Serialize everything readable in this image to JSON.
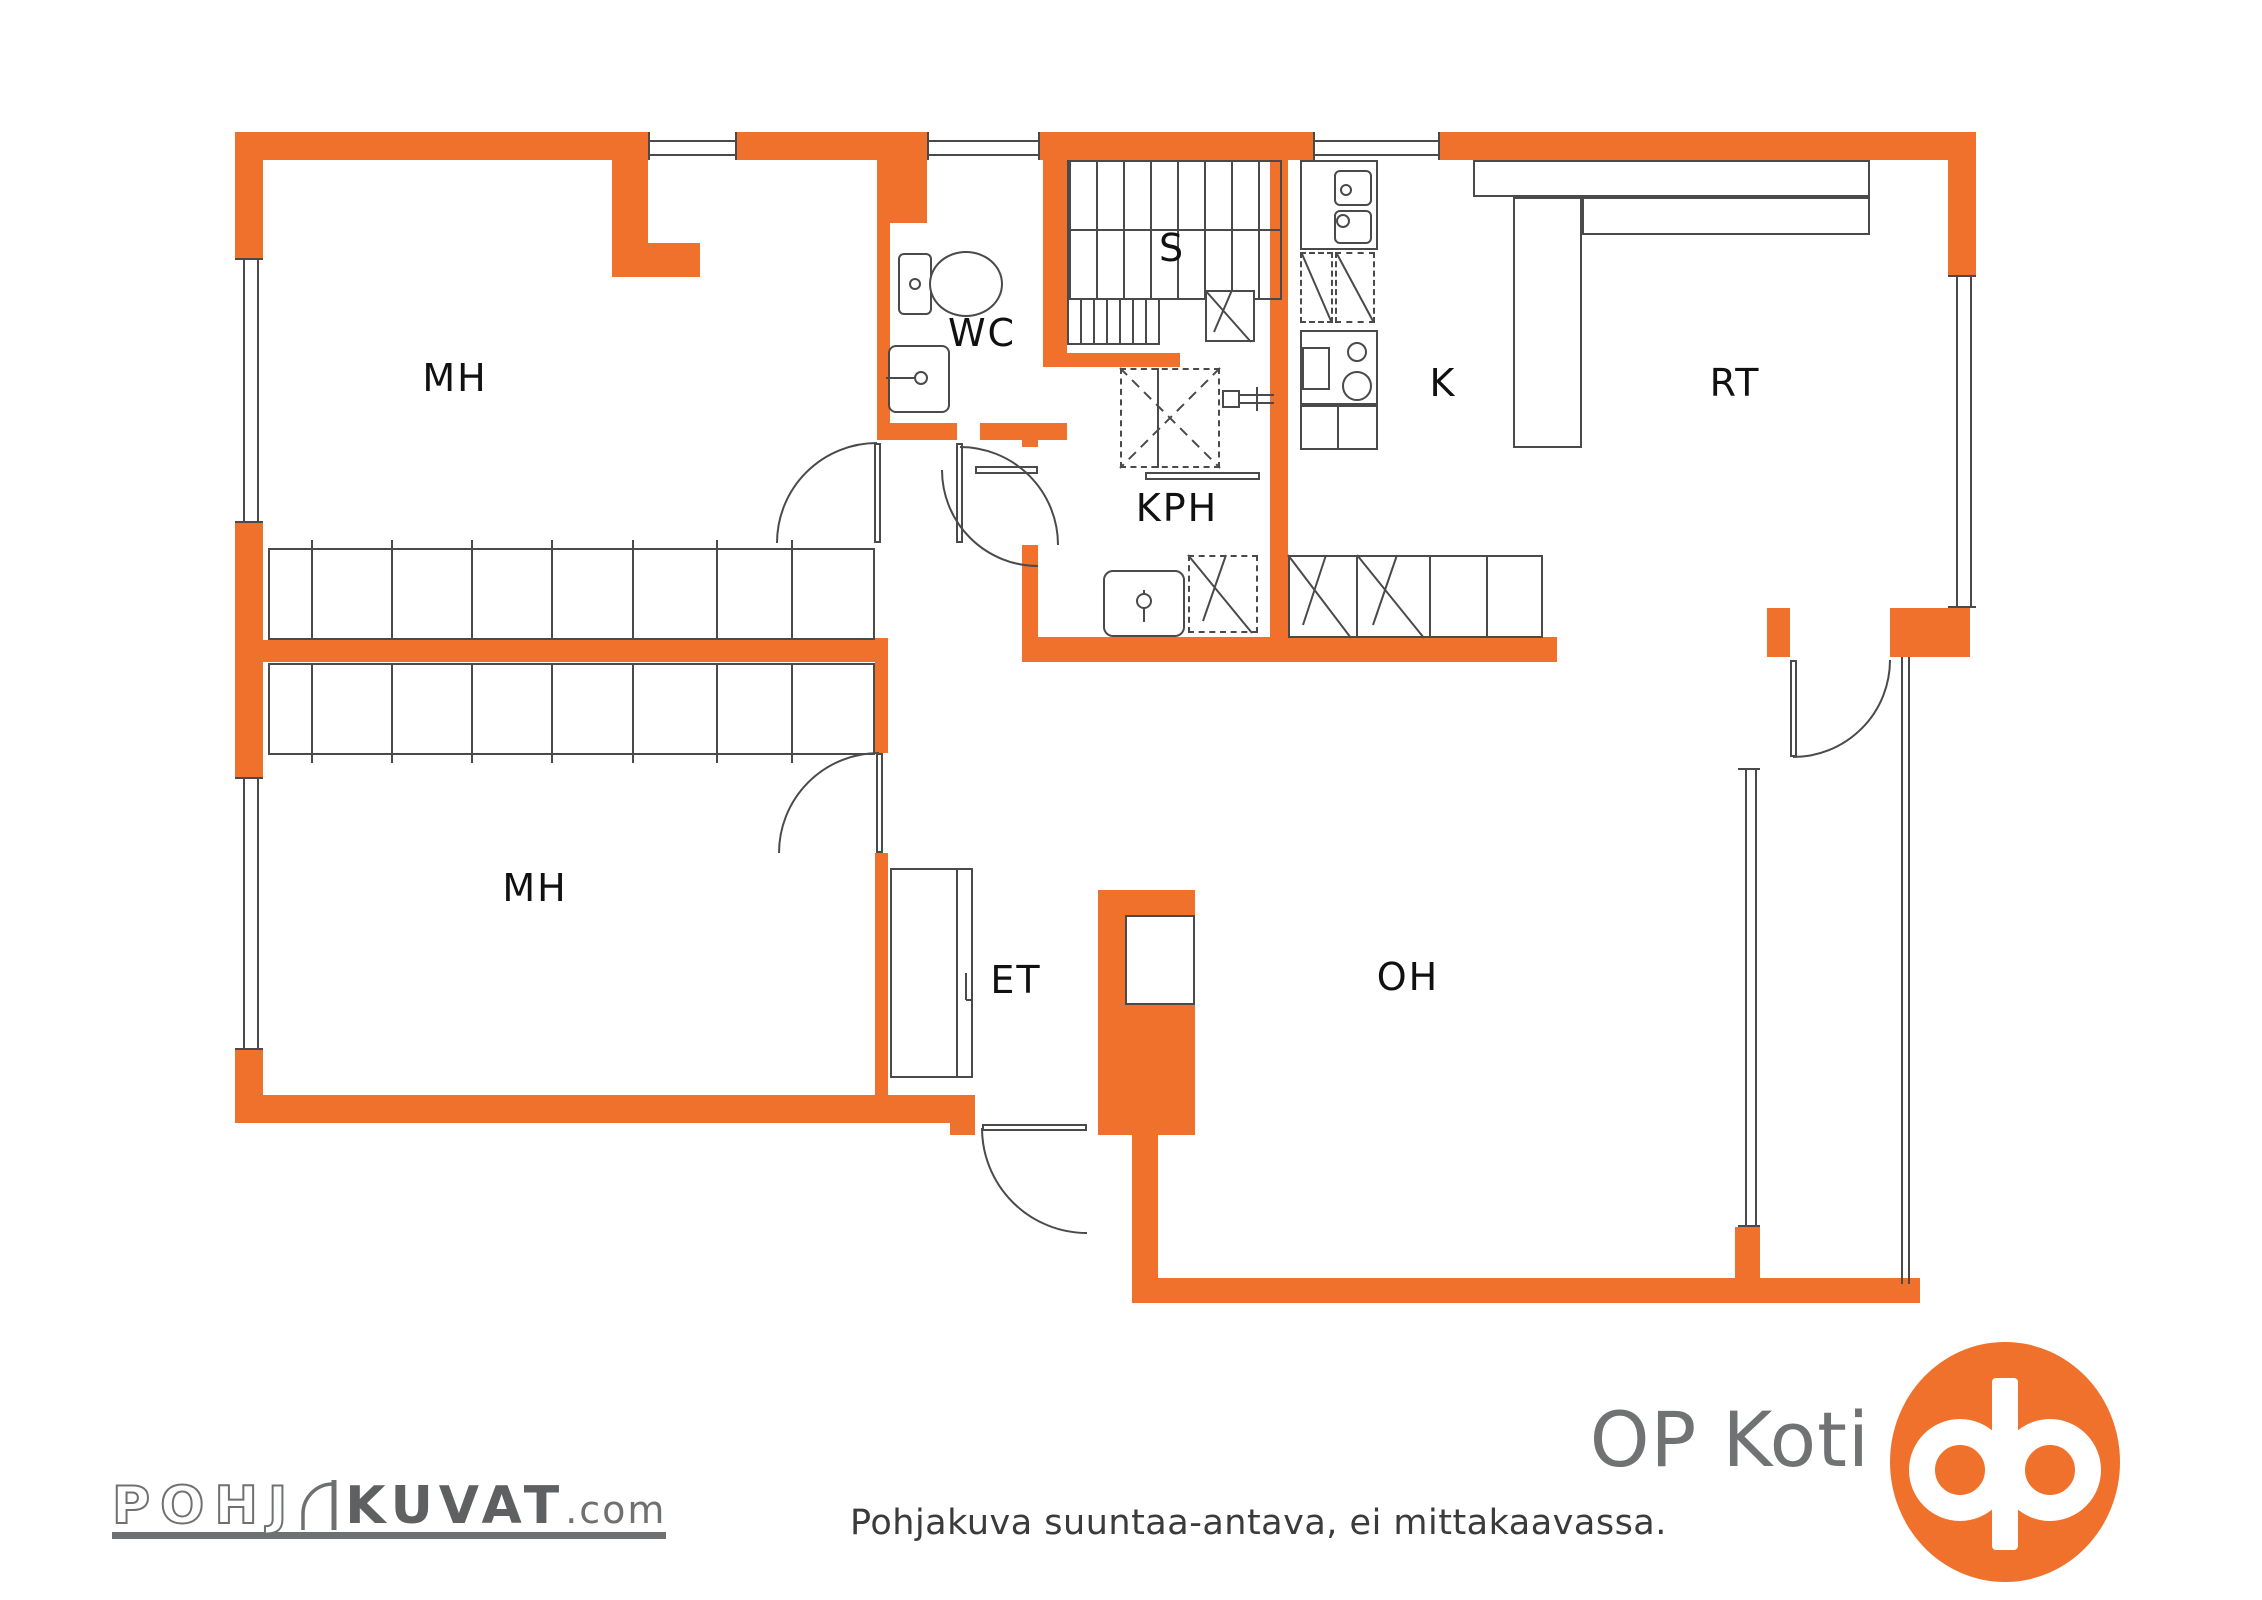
{
  "floorplan": {
    "rooms": {
      "mh_upper": {
        "label": "MH"
      },
      "wc": {
        "label": "WC"
      },
      "stairs": {
        "label": "S"
      },
      "kitchen": {
        "label": "K"
      },
      "rt": {
        "label": "RT"
      },
      "kph": {
        "label": "KPH"
      },
      "mh_lower": {
        "label": "MH"
      },
      "et": {
        "label": "ET"
      },
      "oh": {
        "label": "OH"
      }
    },
    "caption": "Pohjakuva suuntaa-antava, ei mittakaavassa."
  },
  "branding": {
    "op_koti": "OP Koti",
    "pohjakuvat": {
      "part1": "POHJ",
      "part2": "KUVAT",
      "suffix": ".com"
    }
  },
  "colors": {
    "wall_orange": "#F0712B",
    "line_gray": "#4A4A4A",
    "label_black": "#111111",
    "brand_gray": "#6F7072"
  }
}
